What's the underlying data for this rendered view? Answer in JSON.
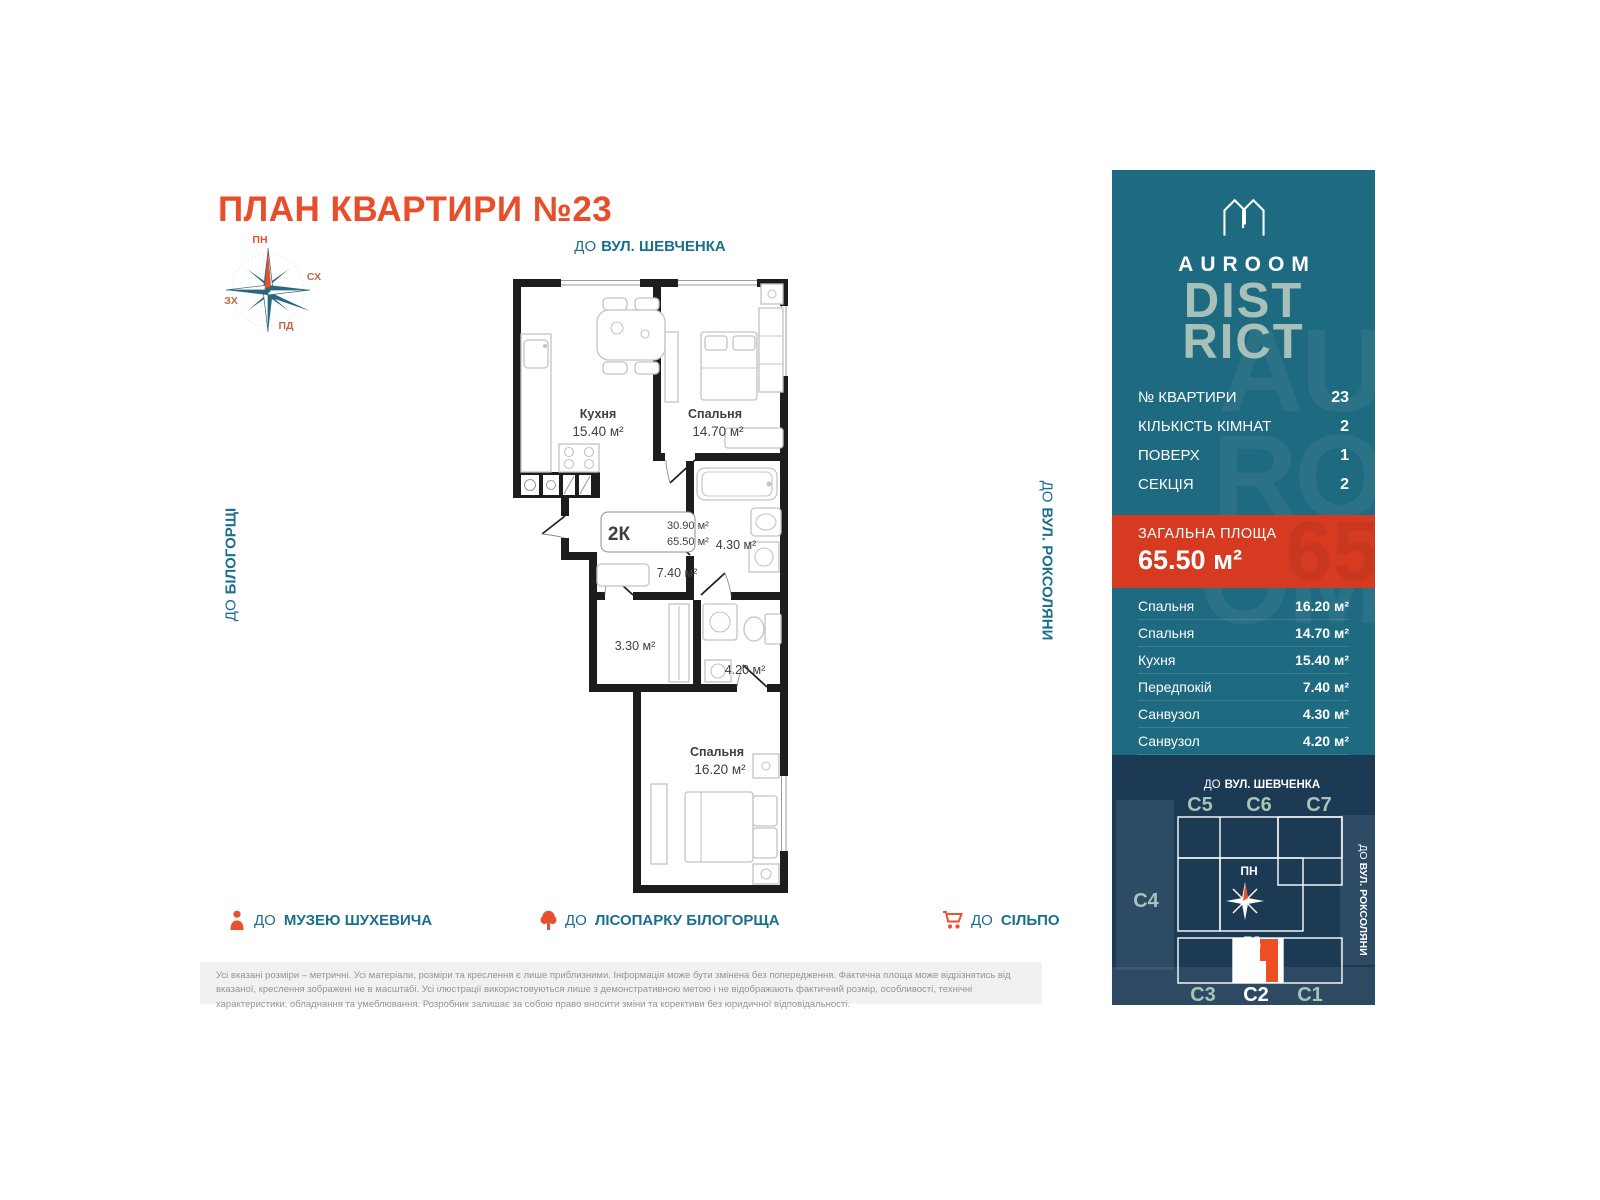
{
  "page": {
    "title": "ПЛАН КВАРТИРИ №23",
    "disclaimer": "Усі вказані розміри – метричні. Усі матеріали, розміри та креслення є лише приблизними. Інформація може бути змінена без попередження. Фактична площа може відрізнятись від вказаної, креслення зображені не в масштабі. Усі ілюстрації використовуються лише з демонстративною метою і не відображають фактичний розмір, особливості, технічні характеристики, обладнання та умеблювання. Розробник залишає за собою право вносити зміни та корективи без юридичної відповідальності."
  },
  "plan": {
    "street_top": {
      "prefix": "ДО",
      "name": "ВУЛ. ШЕВЧЕНКА"
    },
    "street_left": {
      "prefix": "ДО",
      "name": "БІЛОГОРЩІ"
    },
    "street_right": {
      "prefix": "ДО",
      "name": "ВУЛ. РОКСОЛЯНИ"
    },
    "compass": {
      "n": "ПН",
      "e": "СХ",
      "s": "ПД",
      "w": "ЗХ"
    },
    "callout": {
      "type": "2К",
      "living_area": "30.90 м²",
      "total_area": "65.50 м²"
    },
    "rooms": {
      "kitchen": {
        "name": "Кухня",
        "area": "15.40 м²"
      },
      "bedroom1": {
        "name": "Спальня",
        "area": "14.70 м²"
      },
      "bedroom2": {
        "name": "Спальня",
        "area": "16.20 м²"
      },
      "hall_area": "7.40 м²",
      "bath1_area": "4.30 м²",
      "bath2_area": "4.20 м²",
      "wardrobe_area": "3.30 м²"
    }
  },
  "landmarks": [
    {
      "icon": "person-icon",
      "prefix": "ДО",
      "name": "МУЗЕЮ ШУХЕВИЧА"
    },
    {
      "icon": "tree-icon",
      "prefix": "ДО",
      "name": "ЛІСОПАРКУ БІЛОГОРЩА"
    },
    {
      "icon": "cart-icon",
      "prefix": "ДО",
      "name": "СІЛЬПО"
    }
  ],
  "sidebar": {
    "brand": {
      "name": "AUROOM",
      "big_line1": "DIST",
      "big_line2": "RICT"
    },
    "watermark": [
      "AU",
      "RO",
      "OM"
    ],
    "details": [
      {
        "label": "№ КВАРТИРИ",
        "value": "23"
      },
      {
        "label": "КІЛЬКІСТЬ КІМНАТ",
        "value": "2"
      },
      {
        "label": "ПОВЕРХ",
        "value": "1"
      },
      {
        "label": "СЕКЦІЯ",
        "value": "2"
      }
    ],
    "total": {
      "label": "ЗАГАЛЬНА ПЛОЩА",
      "value": "65.50 м²"
    },
    "rooms": [
      {
        "label": "Спальня",
        "value": "16.20 м²"
      },
      {
        "label": "Спальня",
        "value": "14.70 м²"
      },
      {
        "label": "Кухня",
        "value": "15.40 м²"
      },
      {
        "label": "Передпокій",
        "value": "7.40 м²"
      },
      {
        "label": "Санвузол",
        "value": "4.30 м²"
      },
      {
        "label": "Санвузол",
        "value": "4.20 м²"
      },
      {
        "label": "Гардероб",
        "value": "3.30 м²"
      }
    ],
    "map": {
      "street_top": {
        "prefix": "ДО",
        "name": "ВУЛ. ШЕВЧЕНКА"
      },
      "street_right": {
        "prefix": "ДО",
        "name": "ВУЛ. РОКСОЛЯНИ"
      },
      "s5": "С5",
      "s6": "С6",
      "s7": "С7",
      "s4": "С4",
      "s3": "С3",
      "s2": "С2",
      "s1": "С1",
      "compass_n": "ПН",
      "compass_s": "ПД"
    }
  },
  "colors": {
    "accent_orange": "#E84E2B",
    "teal_panel": "#1E6A80",
    "teal_text": "#1B6F8E",
    "navy_map": "#1C3A54",
    "sage": "#A7C1B8",
    "red_block": "#D63B22"
  }
}
